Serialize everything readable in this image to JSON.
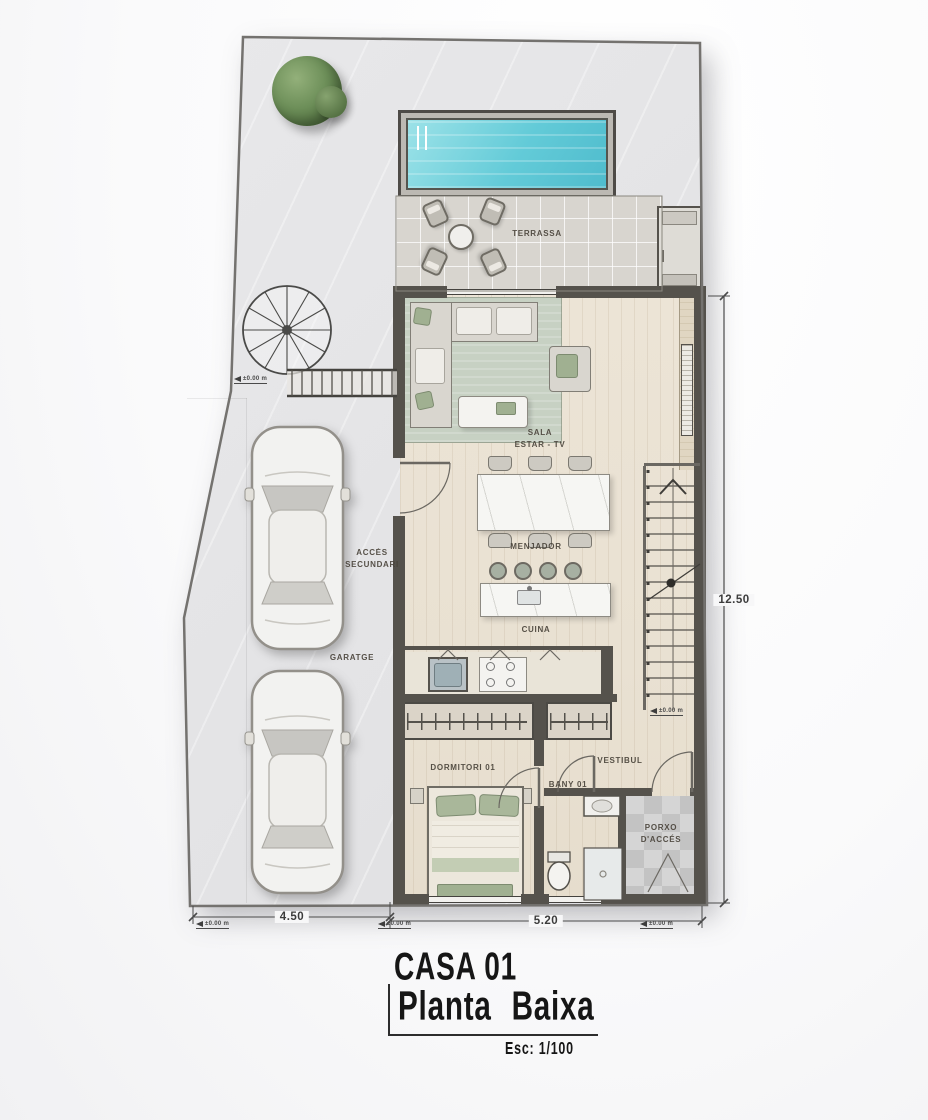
{
  "title": {
    "project": "CASA 01",
    "drawing": "Planta Baixa",
    "scale": "Esc: 1/100"
  },
  "rooms": {
    "terrace": "TERRASSA",
    "living_line1": "SALA",
    "living_line2": "ESTAR - TV",
    "dining": "MENJADOR",
    "kitchen": "CUINA",
    "garage": "GARATGE",
    "secondary_access_line1": "ACCÉS",
    "secondary_access_line2": "SECUNDARI",
    "bedroom": "DORMITORI 01",
    "hall": "VESTIBUL",
    "bathroom": "BANY 01",
    "porch_line1": "PORXO",
    "porch_line2": "D'ACCÉS"
  },
  "dimensions": {
    "bottom_left": "4.50",
    "bottom_right": "5.20",
    "right": "12.50"
  },
  "levels": {
    "text": "±0.00 m"
  },
  "colors": {
    "pool_water": "#63cbd8",
    "wall": "#55524c",
    "floor_wood": "#eae2d4",
    "lot_paving": "#e4e4e6",
    "rug_green": "#c7d1c3",
    "accent_sage": "#a3b394"
  }
}
